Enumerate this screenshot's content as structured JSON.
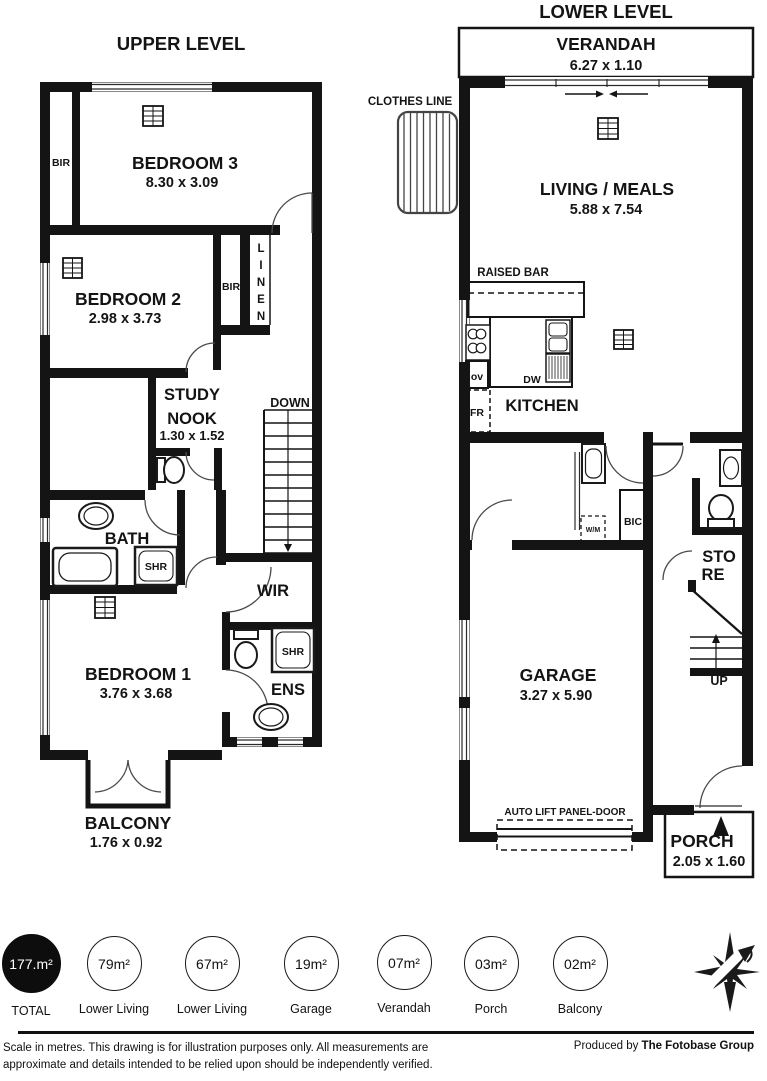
{
  "upper_level": {
    "title": "UPPER LEVEL",
    "rooms": {
      "bedroom3": {
        "name": "BEDROOM 3",
        "dims": "8.30 x 3.09"
      },
      "bedroom2": {
        "name": "BEDROOM 2",
        "dims": "2.98 x 3.73"
      },
      "study_nook": {
        "line1": "STUDY",
        "line2": "NOOK",
        "dims": "1.30 x 1.52"
      },
      "bath": {
        "name": "BATH"
      },
      "wir": {
        "name": "WIR"
      },
      "ens": {
        "name": "ENS"
      },
      "bedroom1": {
        "name": "BEDROOM 1",
        "dims": "3.76 x 3.68"
      },
      "balcony": {
        "name": "BALCONY",
        "dims": "1.76 x 0.92"
      }
    },
    "labels": {
      "bir_bed3": "BIR",
      "bir_bed2": "BIR",
      "linen": "LINEN",
      "down": "DOWN",
      "shr_bath": "SHR",
      "shr_ens": "SHR"
    }
  },
  "lower_level": {
    "title": "LOWER LEVEL",
    "rooms": {
      "verandah": {
        "name": "VERANDAH",
        "dims": "6.27 x 1.10"
      },
      "living_meals": {
        "name": "LIVING / MEALS",
        "dims": "5.88 x 7.54"
      },
      "kitchen": {
        "name": "KITCHEN"
      },
      "garage": {
        "name": "GARAGE",
        "dims": "3.27 x 5.90"
      },
      "store": {
        "line1": "STO",
        "line2": "RE"
      },
      "porch": {
        "name": "PORCH",
        "dims": "2.05 x 1.60"
      }
    },
    "labels": {
      "clothes_line": "CLOTHES LINE",
      "raised_bar": "RAISED BAR",
      "ov": "ov",
      "fr": "FR",
      "dw": "DW",
      "wm": "W/M",
      "bic": "BIC",
      "up": "UP",
      "auto_lift_door": "AUTO LIFT PANEL-DOOR"
    }
  },
  "legend": {
    "items": [
      {
        "value": "177.m²",
        "label": "TOTAL",
        "filled": true
      },
      {
        "value": "79m²",
        "label": "Lower Living",
        "filled": false
      },
      {
        "value": "67m²",
        "label": "Lower Living",
        "filled": false
      },
      {
        "value": "19m²",
        "label": "Garage",
        "filled": false
      },
      {
        "value": "07m²",
        "label": "Verandah",
        "filled": false
      },
      {
        "value": "03m²",
        "label": "Porch",
        "filled": false
      },
      {
        "value": "02m²",
        "label": "Balcony",
        "filled": false
      }
    ]
  },
  "footer": {
    "disclaimer_line1": "Scale in metres. This drawing is for illustration purposes only. All measurements are",
    "disclaimer_line2": "approximate and details intended to be relied upon should be independently verified.",
    "produced_by_prefix": "Produced by ",
    "produced_by_name": "The Fotobase Group"
  },
  "colors": {
    "ink": "#141414",
    "line": "#4a4a4a"
  }
}
